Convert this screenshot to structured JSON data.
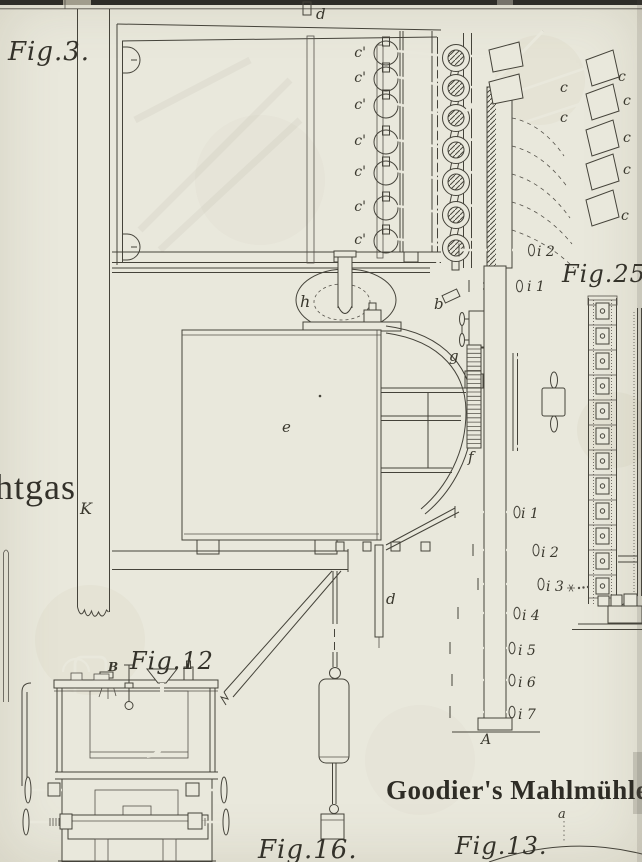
{
  "plate": {
    "title": "Goodier's Mahlmühle",
    "figure_labels": {
      "fig3": "Fig.3.",
      "fig12": "Fig.12",
      "fig13": "Fig.13.",
      "fig16": "Fig.16.",
      "fig25": "Fig.25."
    },
    "text_fragments": {
      "gas": "htgas"
    },
    "parts": {
      "duct_top": "d",
      "duct_lower": "d",
      "frame_column": "K",
      "pulley": "h",
      "crank": "b",
      "pinion": "g",
      "chest": "e",
      "rack": "f",
      "post": "A",
      "fig12_inlet": "B",
      "fig13_point": "a",
      "cam_rollers": [
        "c'",
        "c'",
        "c'",
        "c'",
        "c'",
        "c'",
        "c'"
      ],
      "stamp_heads": [
        "c",
        "c",
        "c",
        "c",
        "c",
        "c",
        "c"
      ],
      "upper_pins": [
        "i 2",
        "i 1"
      ],
      "post_pins": [
        "i 1",
        "i 2",
        "i 3",
        "i 4",
        "i 5",
        "i 6",
        "i 7"
      ]
    },
    "colors": {
      "paper": "#e9e8dc",
      "ink": "#45433a"
    }
  }
}
